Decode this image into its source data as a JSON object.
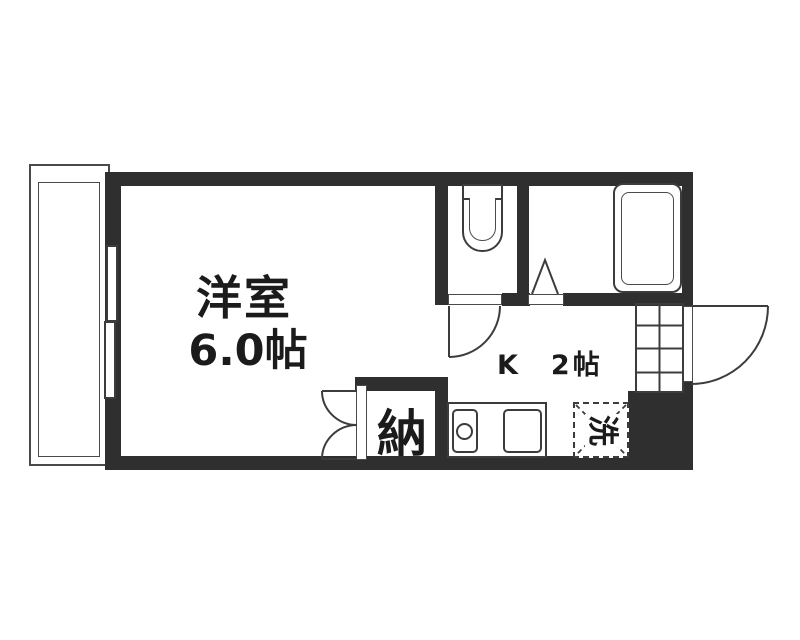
{
  "floorplan": {
    "type": "japanese-apartment-1k",
    "rooms": {
      "western_room": {
        "name": "洋室",
        "size": "6.0帖"
      },
      "kitchen": {
        "label": "K　2帖"
      },
      "closet": {
        "label": "納"
      },
      "laundry": {
        "label": "洗"
      }
    },
    "colors": {
      "wall": "#2f2f2f",
      "line": "#3c3c3c",
      "background": "#ffffff",
      "text": "#1b1b1b"
    }
  }
}
